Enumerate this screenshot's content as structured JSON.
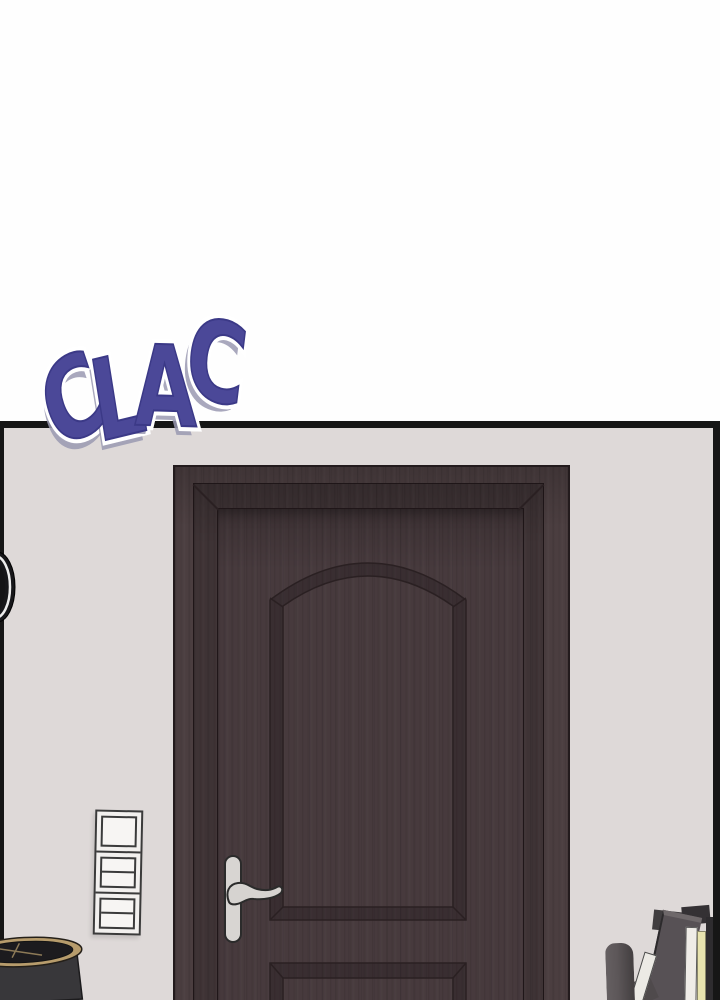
{
  "sfx": {
    "text": "CLAC",
    "letters": [
      "C",
      "L",
      "A",
      "C"
    ],
    "fill_color": "#4b4898",
    "edge_color": "#3b3987",
    "outline_color": "#ffffff",
    "shadow_color": "#9a99b2"
  },
  "panel": {
    "border_color": "#161616",
    "top_background": "#ffffff",
    "wall_color": "#ded9d8"
  },
  "door": {
    "casing_color": "#4b3e40",
    "face_color": "#473a3d",
    "line_color": "#2a2022",
    "handle_color": "#d8d5d2"
  },
  "objects": {
    "wall_clock": {
      "body_color": "#17171a",
      "rim_color": "#ececec"
    },
    "light_switch": {
      "plate_color": "#f2f0ee",
      "line_color": "#3b3b3b",
      "switch_count": 3
    },
    "trash_can": {
      "rim_color": "#b79c6c",
      "body_color": "#38373a",
      "interior_color": "#1c1b1e"
    },
    "books": {
      "spine_colors": [
        "#5d5759",
        "#eceae5",
        "#575155",
        "#efece7",
        "#e8e3af",
        "#2e2c2f"
      ]
    }
  }
}
